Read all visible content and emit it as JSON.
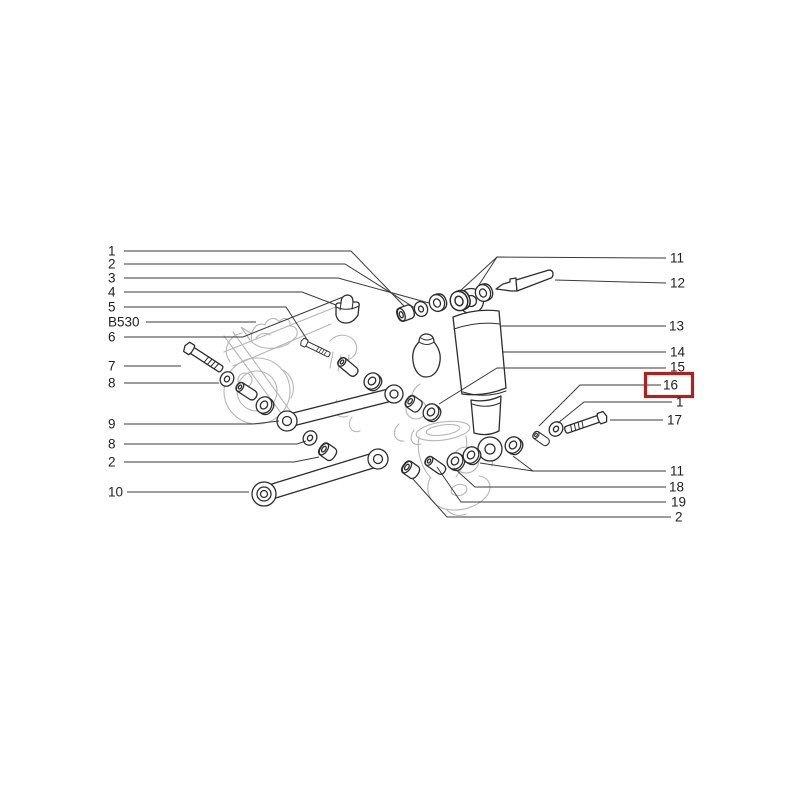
{
  "page": {
    "background": "#ffffff"
  },
  "diagram": {
    "kind": "exploded-parts-diagram",
    "subject": "rear suspension: shock absorber, trailing arms, bushings and fasteners",
    "colors": {
      "background": "#ffffff",
      "line": "#3a3a3a",
      "sketch": "#b6b6b6",
      "label": "#1f1f1f",
      "highlight": "#b0201e"
    },
    "highlight": {
      "label": "16",
      "box": {
        "x": 645.5,
        "y": 373.5,
        "width": 47,
        "height": 23,
        "stroke_width": 3.2
      }
    },
    "callouts": [
      {
        "label": "1",
        "side": "left",
        "x": 108,
        "y": 251,
        "leaders": [
          [
            [
              124,
              251
            ],
            [
              351,
              251
            ],
            [
              404,
              306
            ]
          ]
        ]
      },
      {
        "label": "2",
        "side": "left",
        "x": 108,
        "y": 264,
        "leaders": [
          [
            [
              124,
              264
            ],
            [
              345,
              264
            ],
            [
              415,
              308
            ]
          ]
        ]
      },
      {
        "label": "3",
        "side": "left",
        "x": 108,
        "y": 278,
        "leaders": [
          [
            [
              124,
              278
            ],
            [
              338,
              278
            ],
            [
              429,
              303
            ]
          ]
        ]
      },
      {
        "label": "4",
        "side": "left",
        "x": 108,
        "y": 292,
        "leaders": [
          [
            [
              124,
              292
            ],
            [
              302,
              292
            ],
            [
              336,
              305
            ]
          ]
        ]
      },
      {
        "label": "5",
        "side": "left",
        "x": 108,
        "y": 307,
        "leaders": [
          [
            [
              124,
              307
            ],
            [
              286,
              307
            ],
            [
              308,
              341
            ]
          ]
        ]
      },
      {
        "label": "B530",
        "side": "left",
        "x": 108,
        "y": 322,
        "leaders": [
          [
            [
              146,
              322
            ],
            [
              256,
              322
            ]
          ]
        ]
      },
      {
        "label": "6",
        "side": "left",
        "x": 108,
        "y": 337,
        "leaders": [
          [
            [
              124,
              337
            ],
            [
              243,
              337
            ],
            [
              343,
              297
            ]
          ]
        ]
      },
      {
        "label": "7",
        "side": "left",
        "x": 108,
        "y": 366,
        "leaders": [
          [
            [
              124,
              366
            ],
            [
              181,
              366
            ]
          ]
        ]
      },
      {
        "label": "8",
        "side": "left",
        "x": 108,
        "y": 383,
        "leaders": [
          [
            [
              124,
              383
            ],
            [
              219,
              383
            ]
          ]
        ]
      },
      {
        "label": "9",
        "side": "left",
        "x": 108,
        "y": 424,
        "leaders": [
          [
            [
              124,
              424
            ],
            [
              253,
              424
            ],
            [
              279,
              421
            ]
          ]
        ]
      },
      {
        "label": "8",
        "side": "left",
        "x": 108,
        "y": 444,
        "leaders": [
          [
            [
              124,
              444
            ],
            [
              297,
              444
            ],
            [
              306,
              441
            ]
          ]
        ]
      },
      {
        "label": "2",
        "side": "left",
        "x": 108,
        "y": 462,
        "leaders": [
          [
            [
              124,
              462
            ],
            [
              294,
              462
            ],
            [
              319,
              457
            ]
          ]
        ]
      },
      {
        "label": "10",
        "side": "left",
        "x": 108,
        "y": 492,
        "leaders": [
          [
            [
              127,
              492
            ],
            [
              249,
              492
            ]
          ]
        ]
      },
      {
        "label": "11",
        "side": "right",
        "x": 670,
        "y": 258,
        "leaders": [
          [
            [
              666,
              258
            ],
            [
              497,
              257
            ],
            [
              477,
              288
            ]
          ],
          [
            [
              497,
              257
            ],
            [
              459,
              292
            ]
          ]
        ]
      },
      {
        "label": "12",
        "side": "right",
        "x": 670,
        "y": 283,
        "leaders": [
          [
            [
              666,
              283
            ],
            [
              555,
              280
            ]
          ]
        ]
      },
      {
        "label": "13",
        "side": "right",
        "x": 669,
        "y": 326,
        "leaders": [
          [
            [
              666,
              326
            ],
            [
              501,
              326
            ]
          ]
        ]
      },
      {
        "label": "14",
        "side": "right",
        "x": 670,
        "y": 352,
        "leaders": [
          [
            [
              666,
              352
            ],
            [
              503,
              352
            ]
          ]
        ]
      },
      {
        "label": "15",
        "side": "right",
        "x": 670,
        "y": 367,
        "leaders": [
          [
            [
              666,
              368
            ],
            [
              497,
              368
            ],
            [
              439,
              404
            ]
          ]
        ]
      },
      {
        "label": "16",
        "side": "right",
        "x": 663,
        "y": 385,
        "leaders": [
          [
            [
              661,
              385
            ],
            [
              580,
              385
            ],
            [
              539,
              426
            ]
          ]
        ]
      },
      {
        "label": "1",
        "side": "right",
        "x": 676,
        "y": 402,
        "leaders": [
          [
            [
              672,
              402
            ],
            [
              584,
              402
            ],
            [
              558,
              423
            ]
          ]
        ]
      },
      {
        "label": "17",
        "side": "right",
        "x": 667,
        "y": 420,
        "leaders": [
          [
            [
              663,
              420
            ],
            [
              610,
              420
            ]
          ]
        ]
      },
      {
        "label": "11",
        "side": "right",
        "x": 670,
        "y": 471,
        "leaders": [
          [
            [
              666,
              471
            ],
            [
              533,
              471
            ],
            [
              513,
              456
            ]
          ],
          [
            [
              533,
              471
            ],
            [
              480,
              463
            ]
          ]
        ]
      },
      {
        "label": "18",
        "side": "right",
        "x": 669,
        "y": 487,
        "leaders": [
          [
            [
              666,
              487
            ],
            [
              475,
              487
            ],
            [
              454,
              468
            ]
          ]
        ]
      },
      {
        "label": "19",
        "side": "right",
        "x": 671,
        "y": 502,
        "leaders": [
          [
            [
              666,
              502
            ],
            [
              461,
              502
            ],
            [
              437,
              467
            ]
          ]
        ]
      },
      {
        "label": "2",
        "side": "right",
        "x": 675,
        "y": 517,
        "leaders": [
          [
            [
              671,
              517
            ],
            [
              447,
              517
            ],
            [
              412,
              478
            ]
          ]
        ]
      }
    ]
  }
}
